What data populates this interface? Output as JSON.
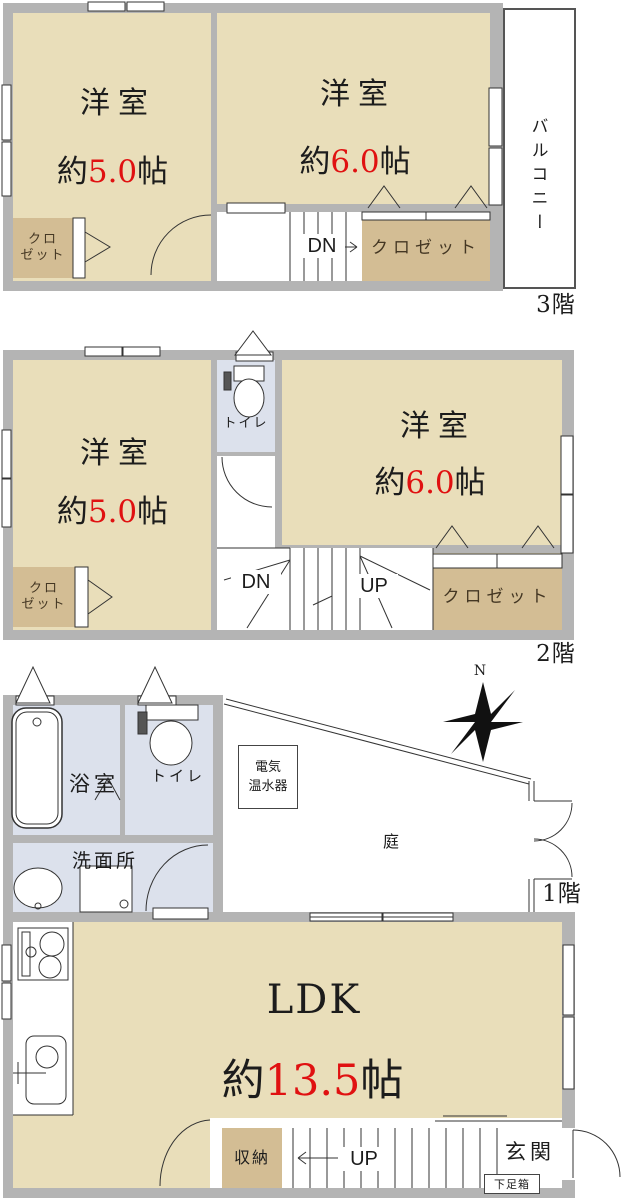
{
  "colors": {
    "wall": "#b4b4b4",
    "room_cream": "#e9deba",
    "closet_tan": "#d3bd94",
    "wet_blue": "#dce1ec",
    "accent_red": "#e01111",
    "line": "#333333"
  },
  "floor3": {
    "floor_label": "3階",
    "balcony_label": "バルコニー",
    "room_small": {
      "name": "洋室",
      "size_prefix": "約",
      "size_value": "5.0",
      "size_suffix": "帖"
    },
    "room_large": {
      "name": "洋室",
      "size_prefix": "約",
      "size_value": "6.0",
      "size_suffix": "帖"
    },
    "closet_left": {
      "line1": "クロ",
      "line2": "ゼット"
    },
    "closet_right": "クロゼット",
    "stairs_down": "DN"
  },
  "floor2": {
    "floor_label": "2階",
    "room_small": {
      "name": "洋室",
      "size_prefix": "約",
      "size_value": "5.0",
      "size_suffix": "帖"
    },
    "room_large": {
      "name": "洋室",
      "size_prefix": "約",
      "size_value": "6.0",
      "size_suffix": "帖"
    },
    "toilet_label": "トイレ",
    "closet_left": {
      "line1": "クロ",
      "line2": "ゼット"
    },
    "closet_right": "クロゼット",
    "stairs_down": "DN",
    "stairs_up": "UP"
  },
  "floor1": {
    "floor_label": "1階",
    "bath_label": "浴室",
    "toilet_label": "トイレ",
    "washroom_label": "洗面所",
    "water_heater": {
      "line1": "電気",
      "line2": "温水器"
    },
    "garden_label": "庭",
    "compass_north": "N",
    "ldk": {
      "name": "LDK",
      "size_prefix": "約",
      "size_value": "13.5",
      "size_suffix": "帖"
    },
    "storage_label": "収納",
    "stairs_up": "UP",
    "entrance_label": "玄関",
    "shoe_box_label": "下足箱"
  }
}
